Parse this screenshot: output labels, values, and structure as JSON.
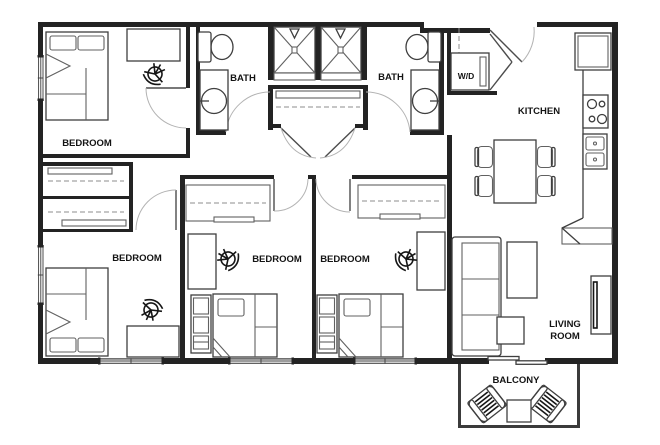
{
  "plan": {
    "labels": {
      "bedroom_tl": "BEDROOM",
      "bedroom_bl": "BEDROOM",
      "bedroom_bm": "BEDROOM",
      "bedroom_br": "BEDROOM",
      "bath_left": "BATH",
      "bath_right": "BATH",
      "washer_dryer": "W/D",
      "kitchen": "KITCHEN",
      "living_line1": "LIVING",
      "living_line2": "ROOM",
      "balcony": "BALCONY"
    },
    "colors": {
      "wall": "#232323",
      "furniture_line": "#5f5f5f",
      "label": "#141414",
      "background": "#ffffff"
    }
  }
}
